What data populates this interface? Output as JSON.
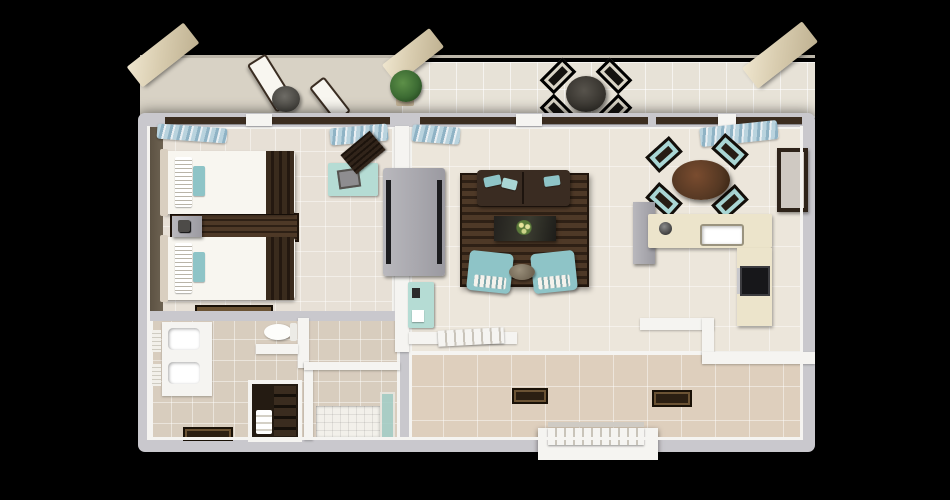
{
  "scene": {
    "kind": "3d-floor-plan-render",
    "view": "top-down",
    "background": "#000000"
  },
  "palette": {
    "bg": "#000000",
    "shell": "#c9c8cd",
    "wallWhite": "#f5f4f1",
    "wallShadow": "#b2b1b6",
    "bedFloor": "#e7e0d6",
    "bedFloorDark": "#6e6352",
    "livFloor": "#ece6db",
    "hallFloor": "#decfbd",
    "bathFloor": "#d8cdbe",
    "gravel": "#d8d2c5",
    "balcTile": "#e7e2d7",
    "darkwood": "#3a2b20",
    "rugA": "#4e3927",
    "rugB": "#2e2015",
    "teal": "#8ec4c7",
    "tealLight": "#a9d6d4",
    "mint": "#b5dcd4",
    "wood": "#553823",
    "chairDark": "#261d14",
    "whiteFurn": "#f8f6f0",
    "mat": "#2b1f12",
    "green": "#3c6b33",
    "awning": "#d9cdb0",
    "counter": "#ece4cb",
    "grayUnit": "#9b9aa1",
    "tv": "#1c1c1f",
    "glass": "#a5cec6",
    "curtainA": "#b9d3de",
    "curtainB": "#8fb3c5",
    "frame": "#3b2d20"
  },
  "rooms": [
    {
      "name": "balcony",
      "furniture": [
        "lounge-chaise",
        "lounge-chaise",
        "side-table",
        "potted-plant",
        "patio-dining-table",
        "patio-chair x4",
        "awning x3"
      ]
    },
    {
      "name": "bedroom",
      "furniture": [
        "twin-bed x2",
        "nightstand",
        "slatted-runner-rug",
        "desk",
        "desk-chair",
        "luggage-mat",
        "curtains",
        "tv-console"
      ]
    },
    {
      "name": "bathroom",
      "furniture": [
        "double-vanity",
        "sink x2",
        "toilet",
        "shelf",
        "bath-mat",
        "linen-closet",
        "shower",
        "glass-panel",
        "towels"
      ]
    },
    {
      "name": "living-room",
      "furniture": [
        "sofa",
        "area-rug",
        "coffee-table",
        "flower-centerpiece",
        "armchair x2",
        "ottoman",
        "minibar",
        "curtains"
      ]
    },
    {
      "name": "dining-area",
      "furniture": [
        "round-dining-table",
        "dining-chair x4"
      ]
    },
    {
      "name": "kitchen",
      "furniture": [
        "l-counter",
        "sink",
        "faucet",
        "kettle",
        "cooktop",
        "tall-cabinet",
        "wall-mirror"
      ]
    },
    {
      "name": "entry-hall",
      "furniture": [
        "doormat x2",
        "louver-entry-door",
        "open-door-leaf"
      ]
    }
  ]
}
